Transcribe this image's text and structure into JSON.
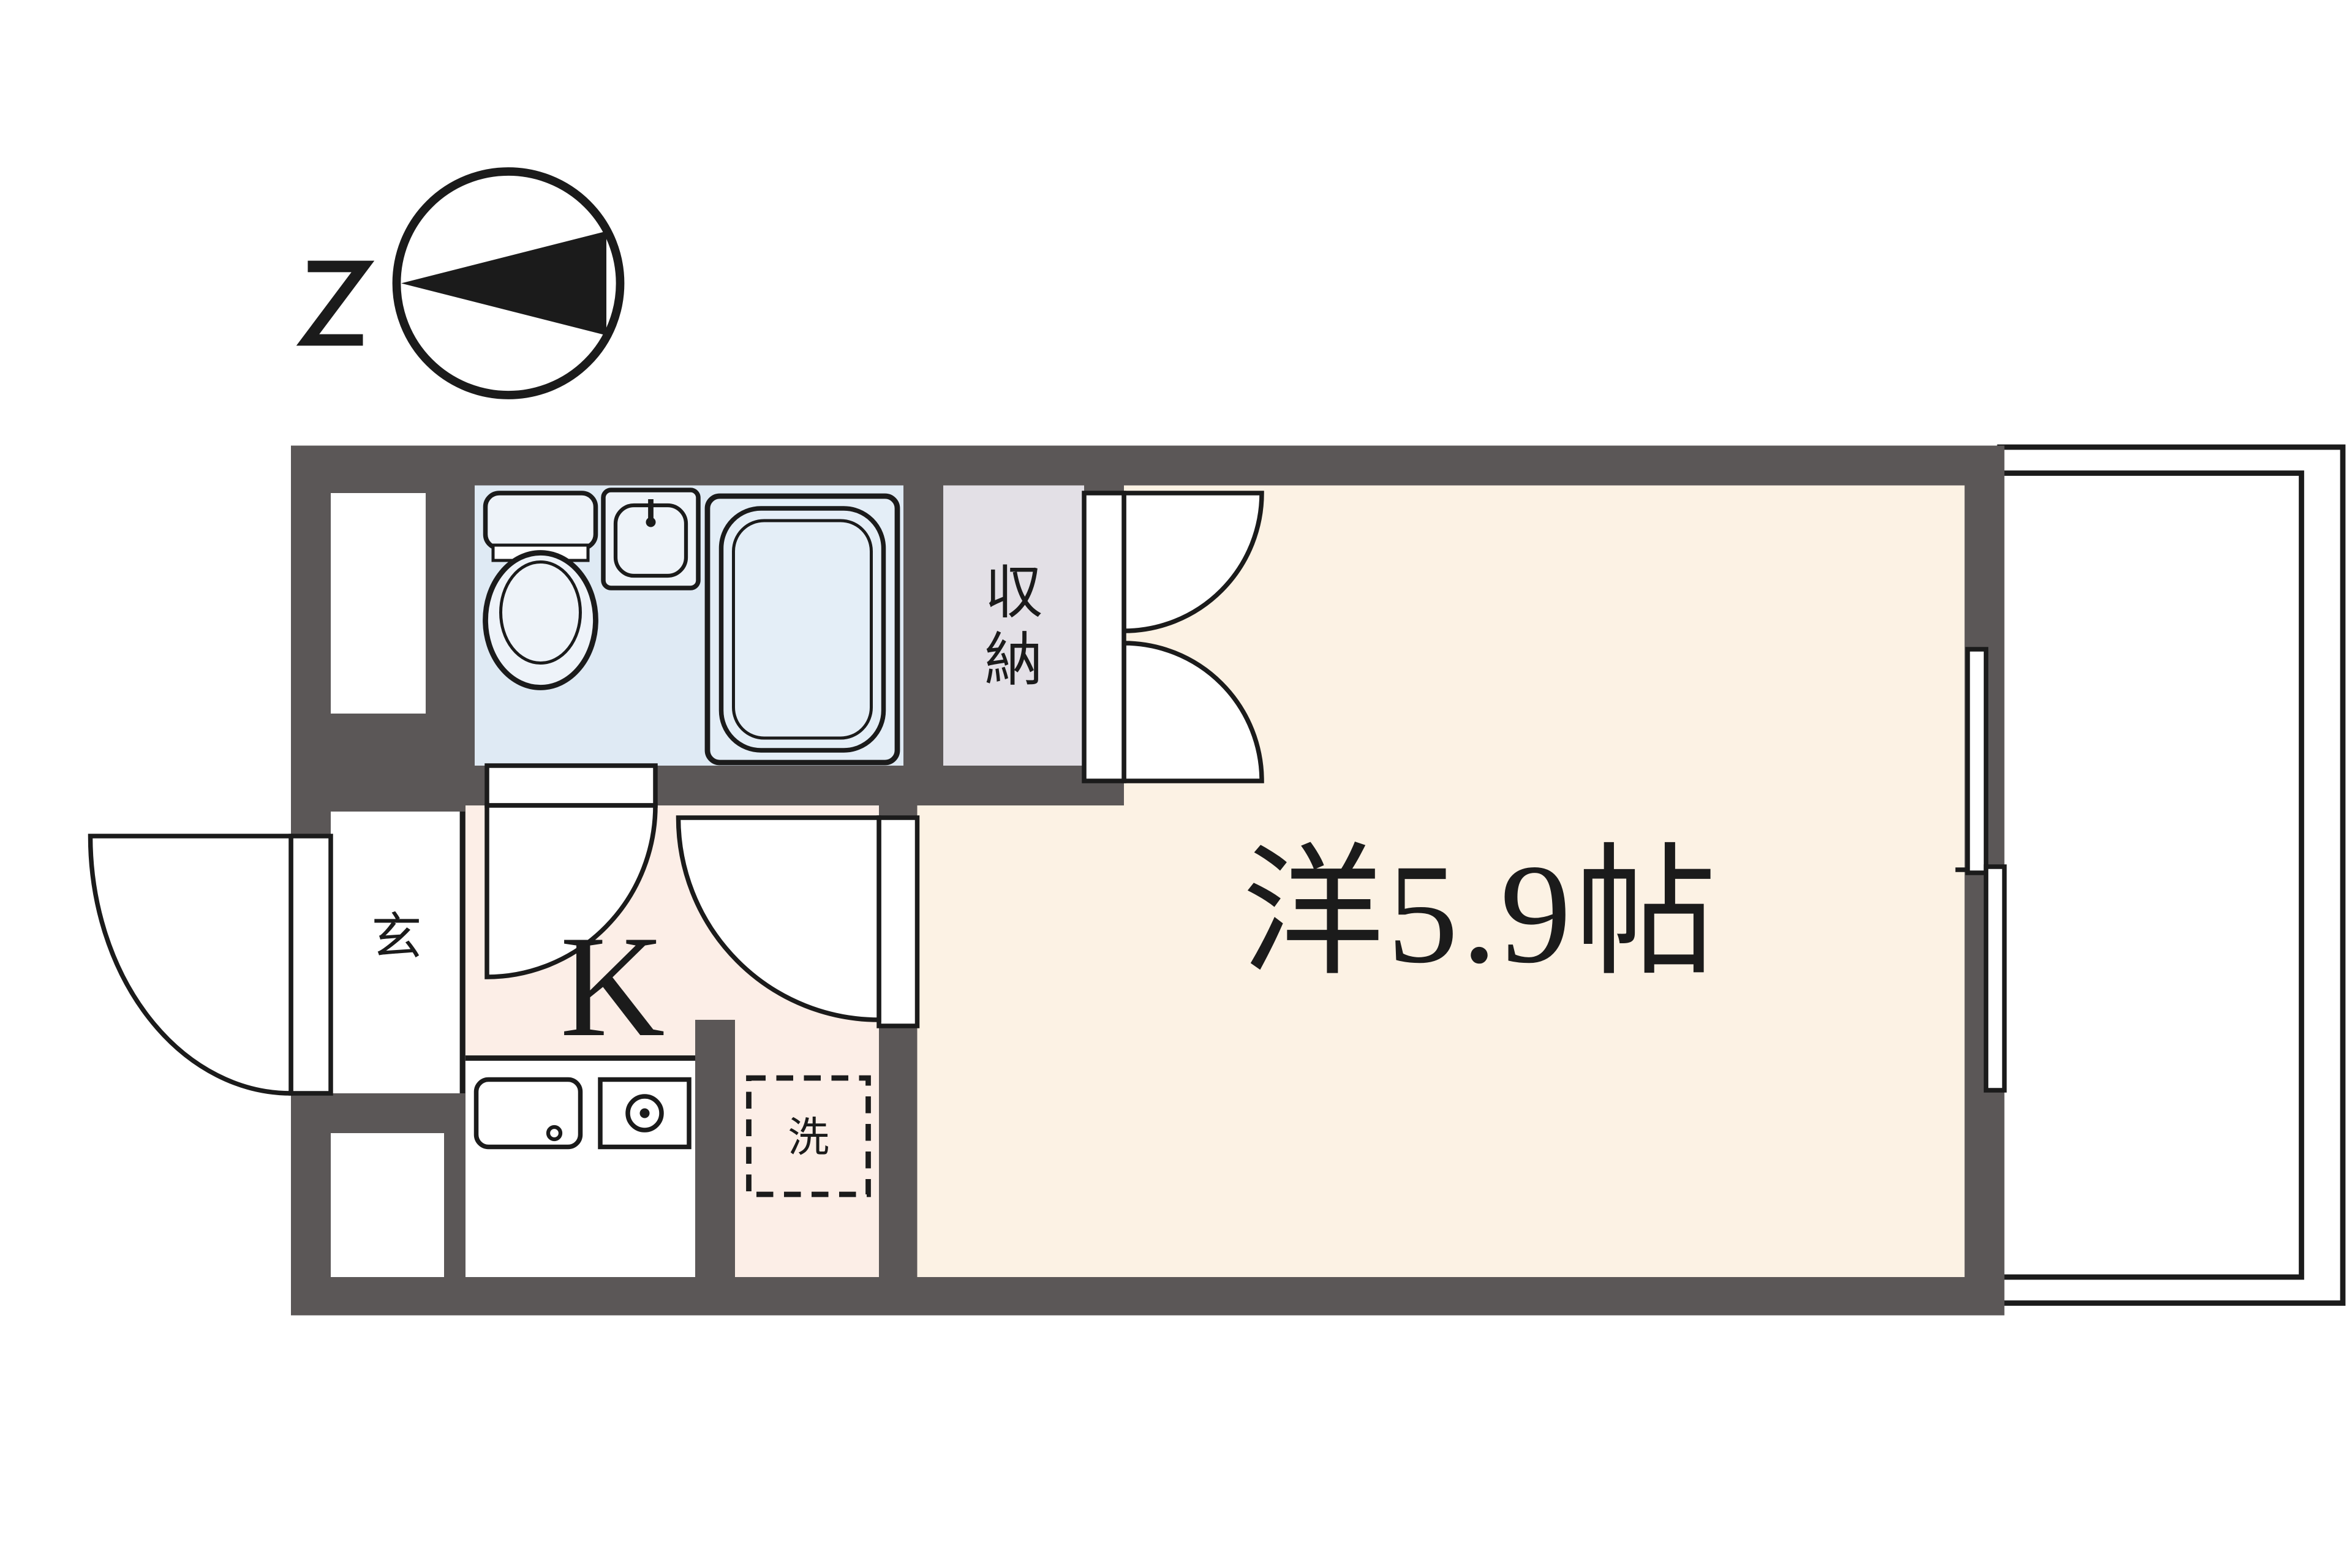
{
  "compass": {
    "label": "N",
    "needle_points": "left"
  },
  "rooms": {
    "main_room": {
      "label": "洋5.9帖",
      "floor_color": "#fcf2e4"
    },
    "kitchen": {
      "label": "K",
      "floor_color": "#fceee7"
    },
    "entrance": {
      "label": "玄",
      "floor_color": "#ffffff"
    },
    "storage": {
      "label": "収納",
      "char_top": "収",
      "char_bottom": "納",
      "floor_color": "#e3e0e6"
    },
    "bathroom": {
      "floor_color": "#dfeaf4",
      "fixtures": [
        "toilet",
        "wash-basin",
        "bathtub"
      ]
    },
    "laundry_space": {
      "label": "洗"
    }
  },
  "palette": {
    "wall": "#5b5757",
    "line": "#1b1b1b",
    "fixture_fill": "#eef3f9",
    "bathtub_fill": "#e4eef7",
    "paper": "#ffffff"
  }
}
